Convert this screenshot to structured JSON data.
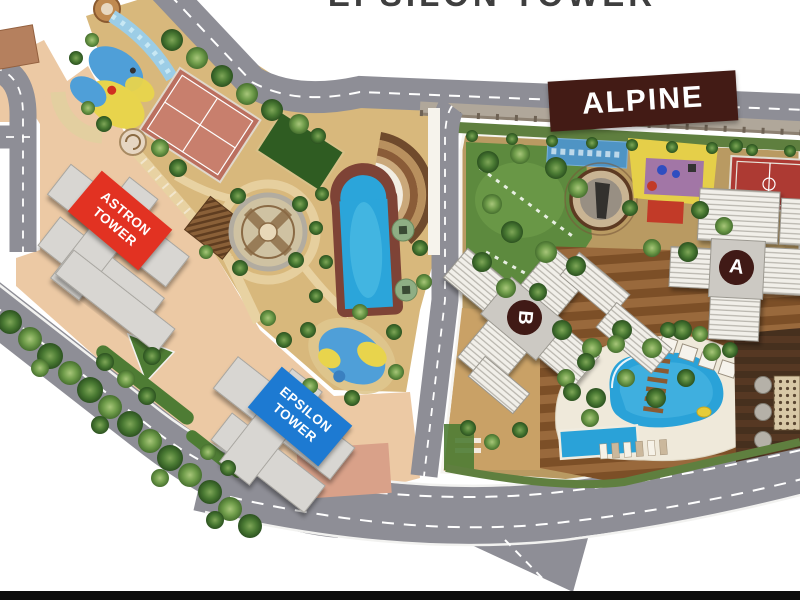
{
  "heading": {
    "title": "EPSILON TOWER"
  },
  "map": {
    "alpine_banner": "ALPINE",
    "tower_labels": {
      "astron": "ASTRON\nTOWER",
      "epsilon": "EPSILON\nTOWER"
    },
    "building_badges": {
      "a": "A",
      "b": "B"
    }
  },
  "colors": {
    "astron_label_bg": "#e23222",
    "epsilon_label_bg": "#1d7ad2",
    "alpine_banner_bg": "#431b15",
    "badge_bg": "#401a16",
    "road": "#8e8e96",
    "pool_water": "#2aa2d8",
    "lawn_green": "#5d8a3e",
    "plaza_peach": "#ecc9a4",
    "garden_tan": "#d8b87c",
    "letterbox_bar": "#0d0d0d"
  }
}
